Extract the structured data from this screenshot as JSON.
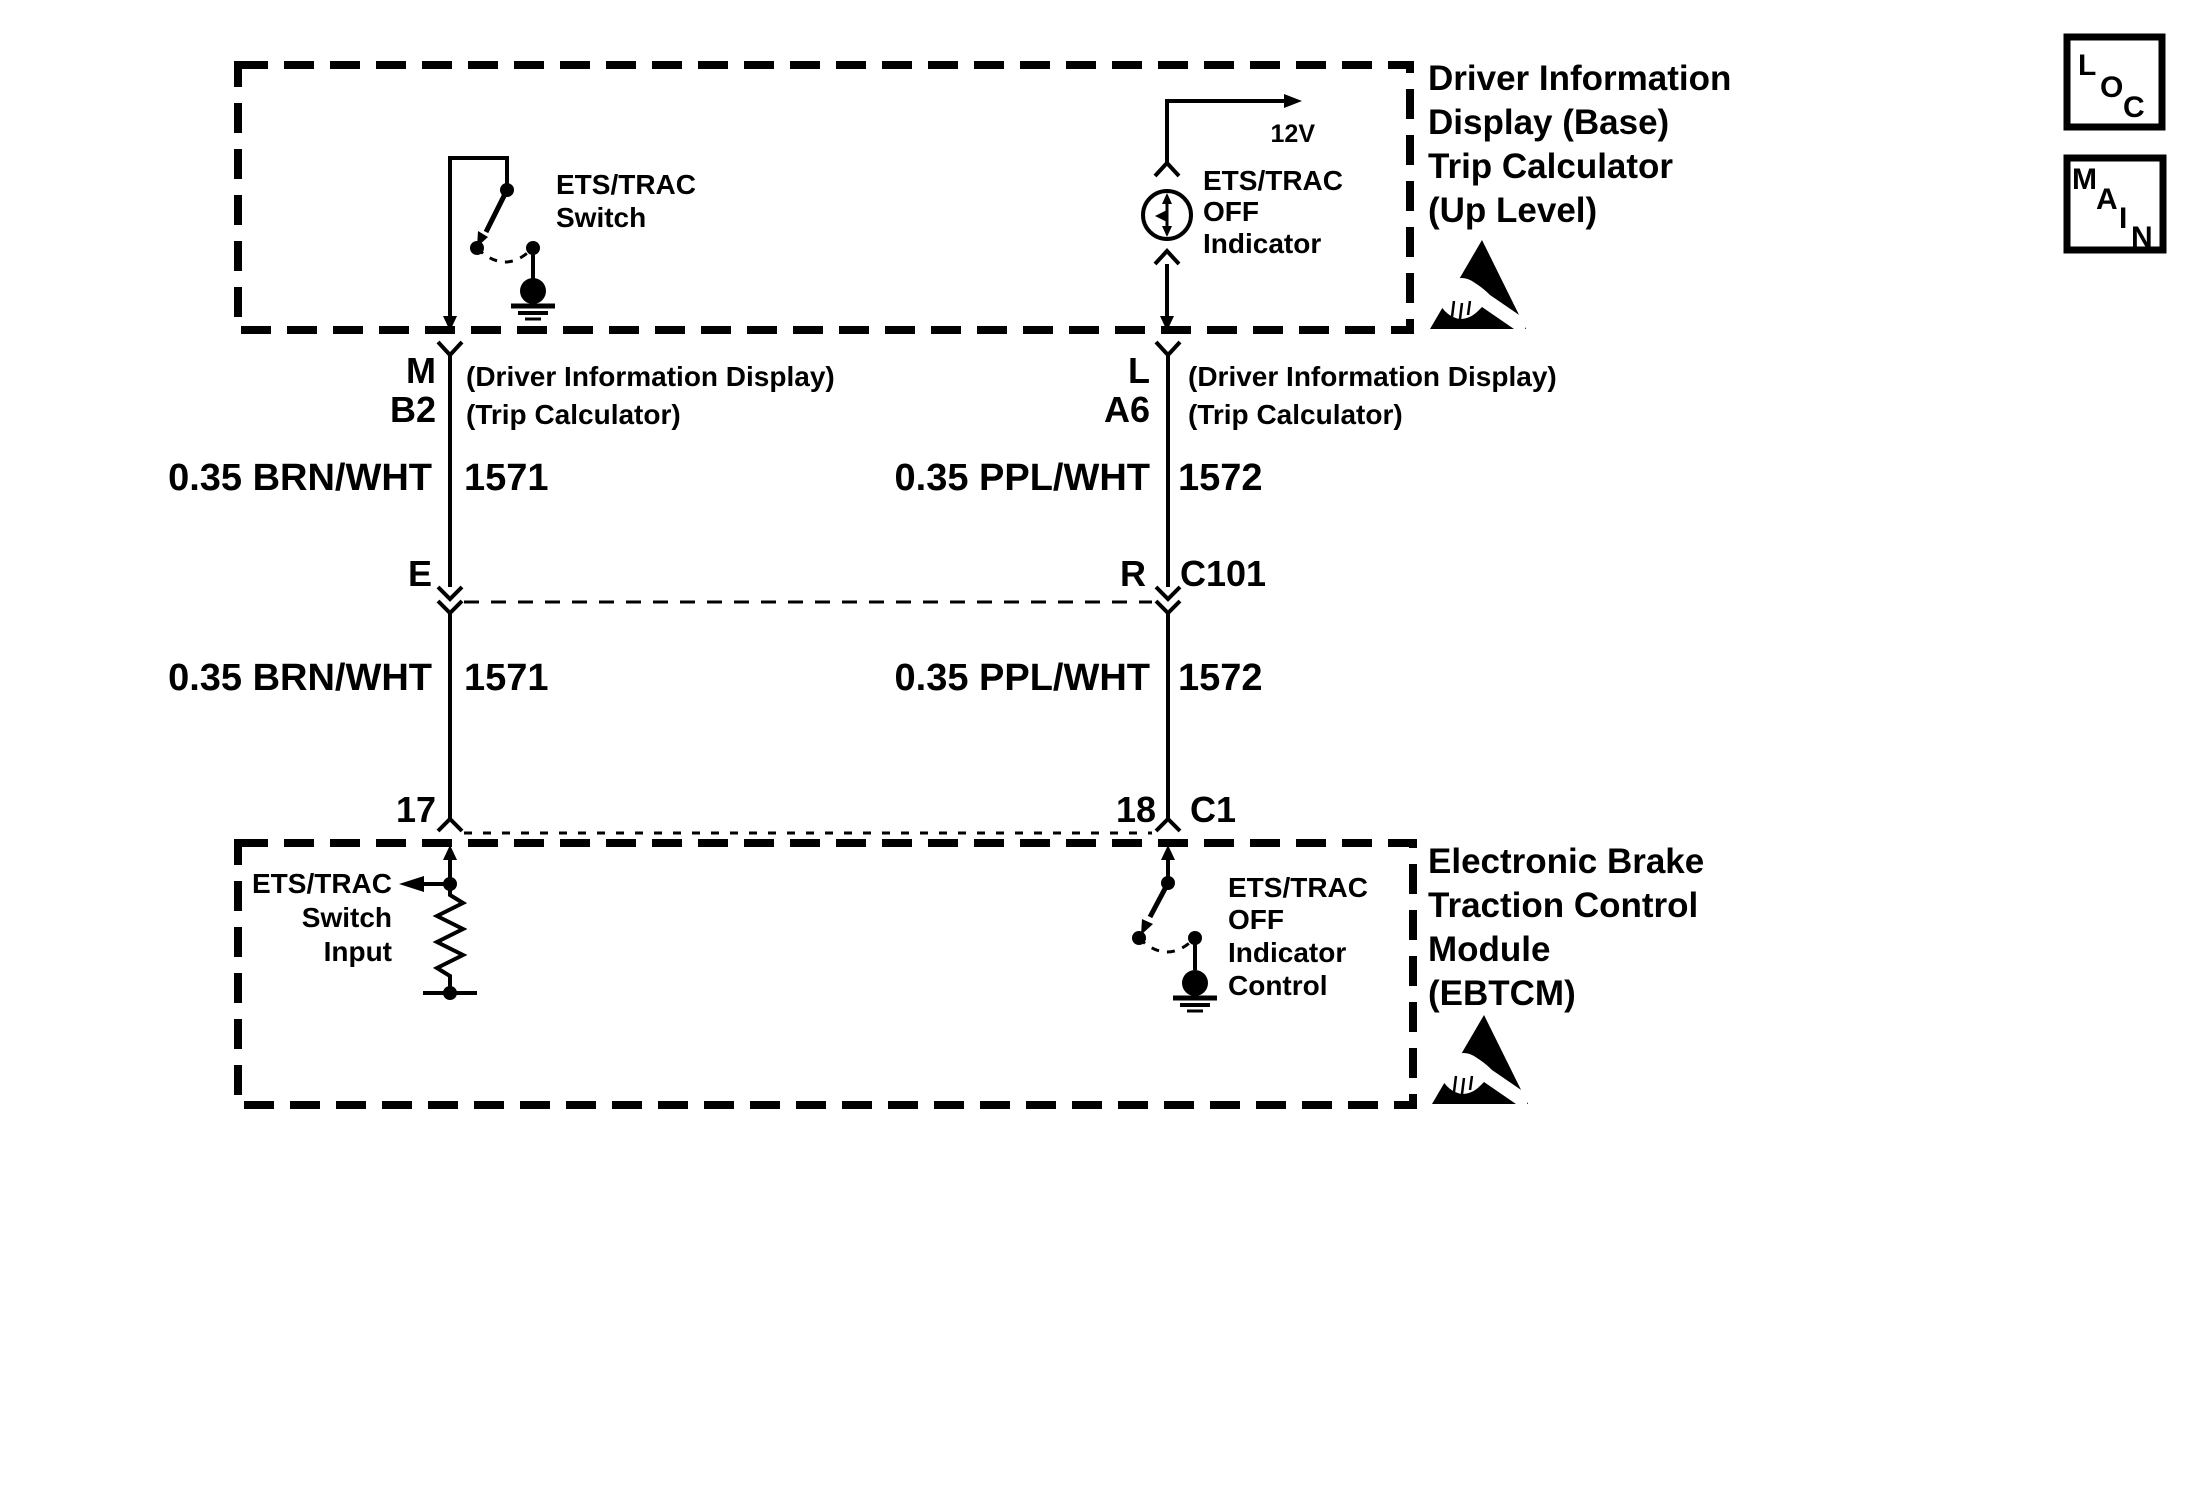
{
  "colors": {
    "ink": "#000000",
    "paper": "#ffffff"
  },
  "nav": {
    "loc": {
      "letters": [
        "L",
        "O",
        "C"
      ]
    },
    "main": {
      "letters": [
        "M",
        "A",
        "I",
        "N"
      ]
    }
  },
  "did_module": {
    "title": [
      "Driver Information",
      "Display (Base)",
      "Trip Calculator",
      "(Up Level)"
    ],
    "switch_label": [
      "ETS/TRAC",
      "Switch"
    ],
    "indicator_label": [
      "ETS/TRAC",
      "OFF",
      "Indicator"
    ],
    "voltage": "12V"
  },
  "ebtcm_module": {
    "title": [
      "Electronic Brake",
      "Traction Control",
      "Module",
      "(EBTCM)"
    ],
    "switch_input_label": [
      "ETS/TRAC",
      "Switch",
      "Input"
    ],
    "indicator_control_label": [
      "ETS/TRAC",
      "OFF",
      "Indicator",
      "Control"
    ]
  },
  "pins": {
    "top_left": {
      "pin": "M",
      "cavity": "B2",
      "note1": "(Driver Information Display)",
      "note2": "(Trip Calculator)"
    },
    "top_right": {
      "pin": "L",
      "cavity": "A6",
      "note1": "(Driver Information Display)",
      "note2": "(Trip Calculator)"
    },
    "mid_left": {
      "pin": "E"
    },
    "mid_right": {
      "pin": "R",
      "connector": "C101"
    },
    "bottom_left": {
      "pin": "17"
    },
    "bottom_right": {
      "pin": "18",
      "connector": "C1"
    }
  },
  "wires": {
    "left_upper": {
      "gauge_color": "0.35 BRN/WHT",
      "circuit": "1571"
    },
    "right_upper": {
      "gauge_color": "0.35 PPL/WHT",
      "circuit": "1572"
    },
    "left_lower": {
      "gauge_color": "0.35 BRN/WHT",
      "circuit": "1571"
    },
    "right_lower": {
      "gauge_color": "0.35 PPL/WHT",
      "circuit": "1572"
    }
  }
}
